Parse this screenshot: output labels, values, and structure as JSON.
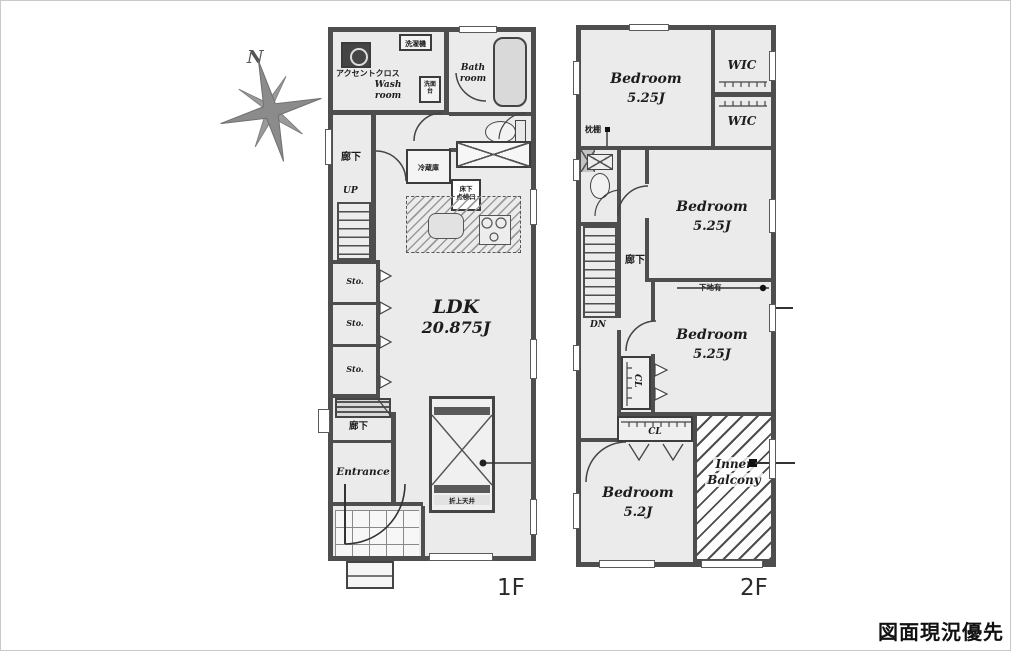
{
  "palette": {
    "wall": "#4e4e4e",
    "floor": "#ebebeb",
    "paper": "#ffffff"
  },
  "caption": "図面現況優先",
  "compass": {
    "north": "N"
  },
  "floor1": {
    "label": "1F",
    "accent_cloth": "アクセントクロス",
    "wash_room_l1": "Wash",
    "wash_room_l2": "room",
    "washer": "洗濯機",
    "vanity": "洗面台",
    "bath_l1": "Bath",
    "bath_l2": "room",
    "fridge": "冷蔵庫",
    "floor_hatch_l1": "床下",
    "floor_hatch_l2": "点検口",
    "corridor_top": "廊下",
    "up": "UP",
    "sto": [
      "Sto.",
      "Sto.",
      "Sto."
    ],
    "ldk_name": "LDK",
    "ldk_size": "20.875J",
    "corridor_bottom": "廊下",
    "entrance": "Entrance",
    "ceiling_note": "折上天井"
  },
  "floor2": {
    "label": "2F",
    "bedroom1_name": "Bedroom",
    "bedroom1_size": "5.25J",
    "wic1": "WIC",
    "wic2": "WIC",
    "pillow_shelf": "枕棚",
    "corridor": "廊下",
    "dn": "DN",
    "bedroom2_name": "Bedroom",
    "bedroom2_size": "5.25J",
    "wall_note": "下地有",
    "bedroom3_name": "Bedroom",
    "bedroom3_size": "5.25J",
    "cl1": "CL",
    "cl2": "CL",
    "bedroom4_name": "Bedroom",
    "bedroom4_size": "5.2J",
    "balcony_l1": "Inner",
    "balcony_l2": "Balcony"
  }
}
